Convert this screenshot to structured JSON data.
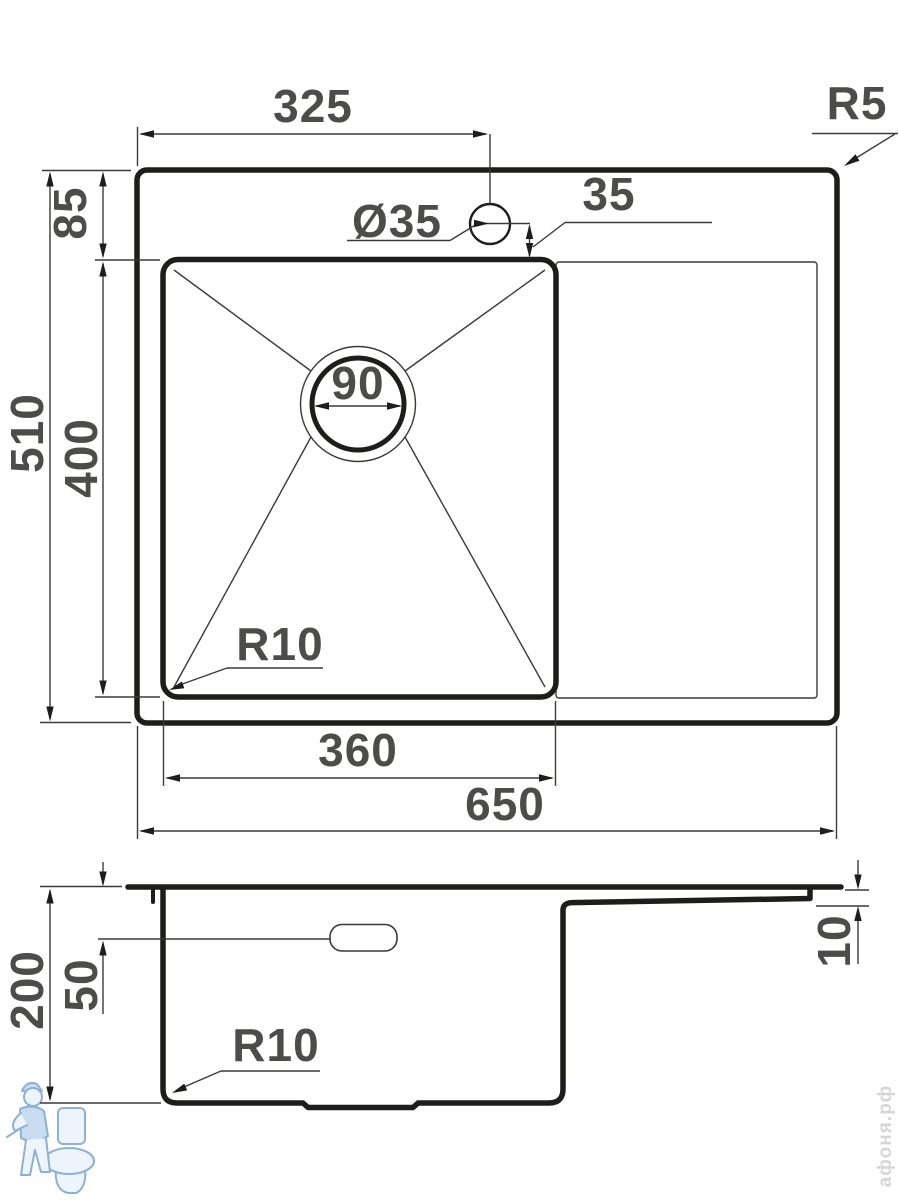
{
  "top_view": {
    "tap_hole_offset": "325",
    "outer_corner_radius": "R5",
    "rim_to_bowl_top": "85",
    "tap_hole_diameter": "Ø35",
    "tap_hole_to_bowl": "35",
    "total_depth": "510",
    "bowl_depth": "400",
    "drain_diameter": "90",
    "bowl_corner_radius": "R10",
    "bowl_width": "360",
    "total_width": "650"
  },
  "side_view": {
    "total_height": "200",
    "overflow_offset": "50",
    "rim_thickness": "10",
    "bottom_corner_radius": "R10"
  },
  "watermark": {
    "brand_text": "афоня.рф"
  },
  "colors": {
    "line_black": "#1d1d1b",
    "thin_line": "#3a3a39",
    "dimension_text": "#4c4c4b",
    "watermark_blue_fill": "#c9dcf0",
    "watermark_blue_stroke": "#8db1d6",
    "watermark_text_gray": "#d6d6d6",
    "background": "#ffffff"
  }
}
